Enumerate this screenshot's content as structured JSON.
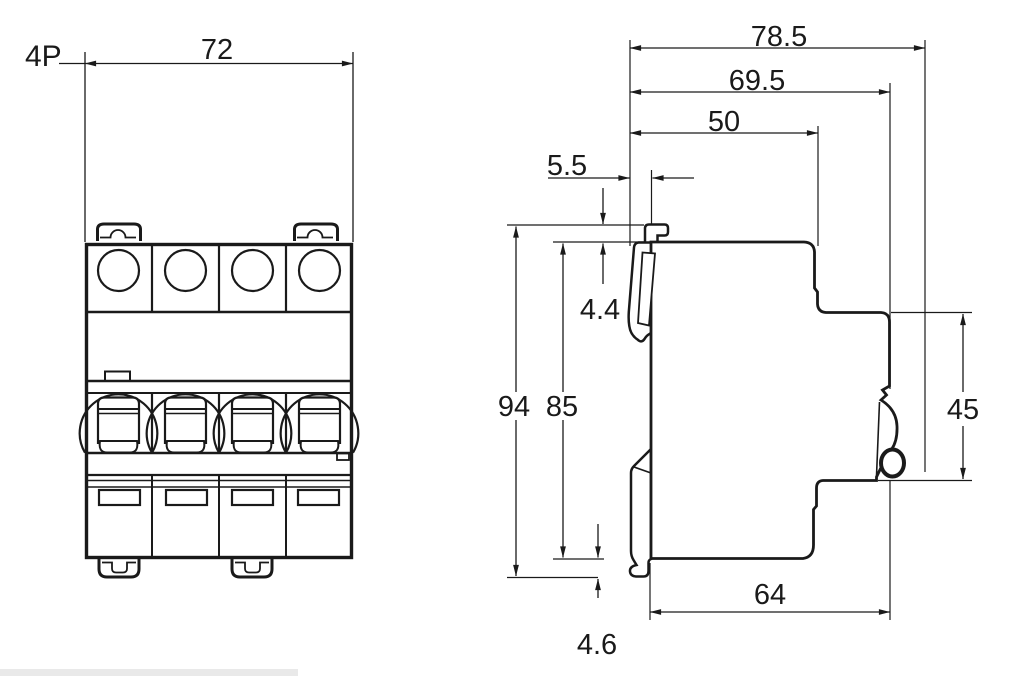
{
  "colors": {
    "line": "#1a1a1a",
    "background": "#ffffff",
    "panel_edge": "#e9e9e9"
  },
  "dims": {
    "pole_label": "4P",
    "front_width": "72",
    "overall_depth": "78.5",
    "depth_without_handle": "69.5",
    "upper_depth": "50",
    "handle_protrusion": "5.5",
    "top_clip_height": "4.4",
    "overall_height": "94",
    "body_height": "85",
    "din_recess": "45",
    "lower_depth": "64",
    "bottom_clip_height": "4.6"
  }
}
